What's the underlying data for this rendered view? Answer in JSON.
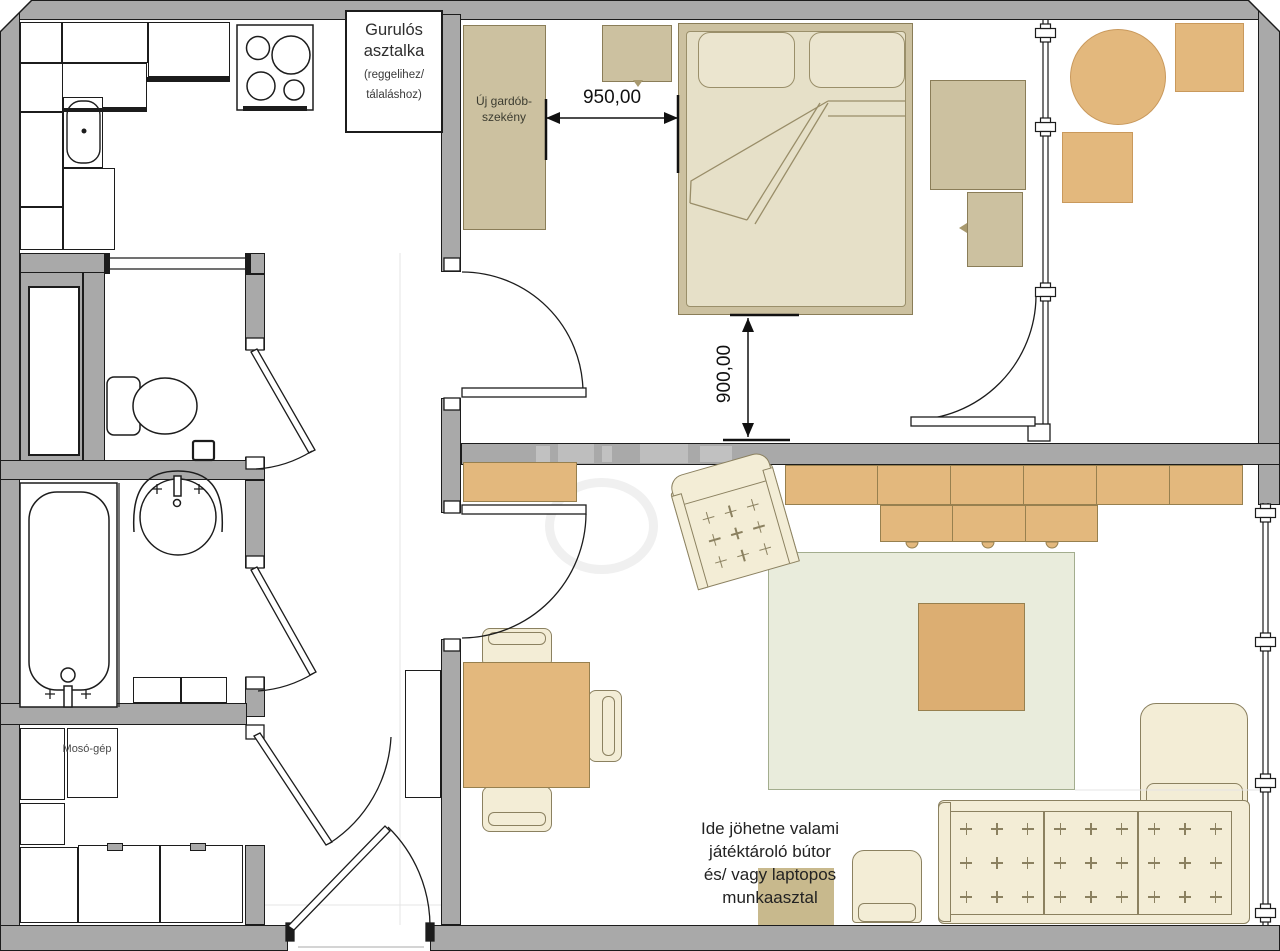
{
  "floorplan": {
    "kitchen": {
      "rolling_table_note": {
        "title": "Gurulós asztalka",
        "subtitle_line1": "(reggelihez/",
        "subtitle_line2": "tálaláshoz)"
      }
    },
    "bedroom": {
      "wardrobe_label": "Új gardób-szekény",
      "width_dimension": "950,00",
      "clearance_dimension": "900,00"
    },
    "utility_room": {
      "washing_machine_label": "Mosó-gép"
    },
    "living_room": {
      "suggestion_note_lines": [
        "Ide jöhetne valami",
        "játéktároló bútor",
        "és/ vagy laptopos",
        "munkaasztal"
      ]
    }
  },
  "colors": {
    "wall": "#a9a9a9",
    "outline": "#1c1c1c",
    "tan": "#ccc1a0",
    "tan-border": "#8a7d58",
    "mattress": "#e6e0c8",
    "pillow": "#ebe5cf",
    "pillow-border": "#9a8f6a",
    "orange": "#e3b87d",
    "orange-border": "#97804f",
    "cream": "#f3edd6",
    "cream-border": "#8b8160",
    "rug": "#e9ecdc",
    "rug-border": "#a3ad8e",
    "coffee": "#dcae72",
    "laptop": "#c8b98d",
    "ink": "#111111",
    "label": "#3c3c30"
  }
}
